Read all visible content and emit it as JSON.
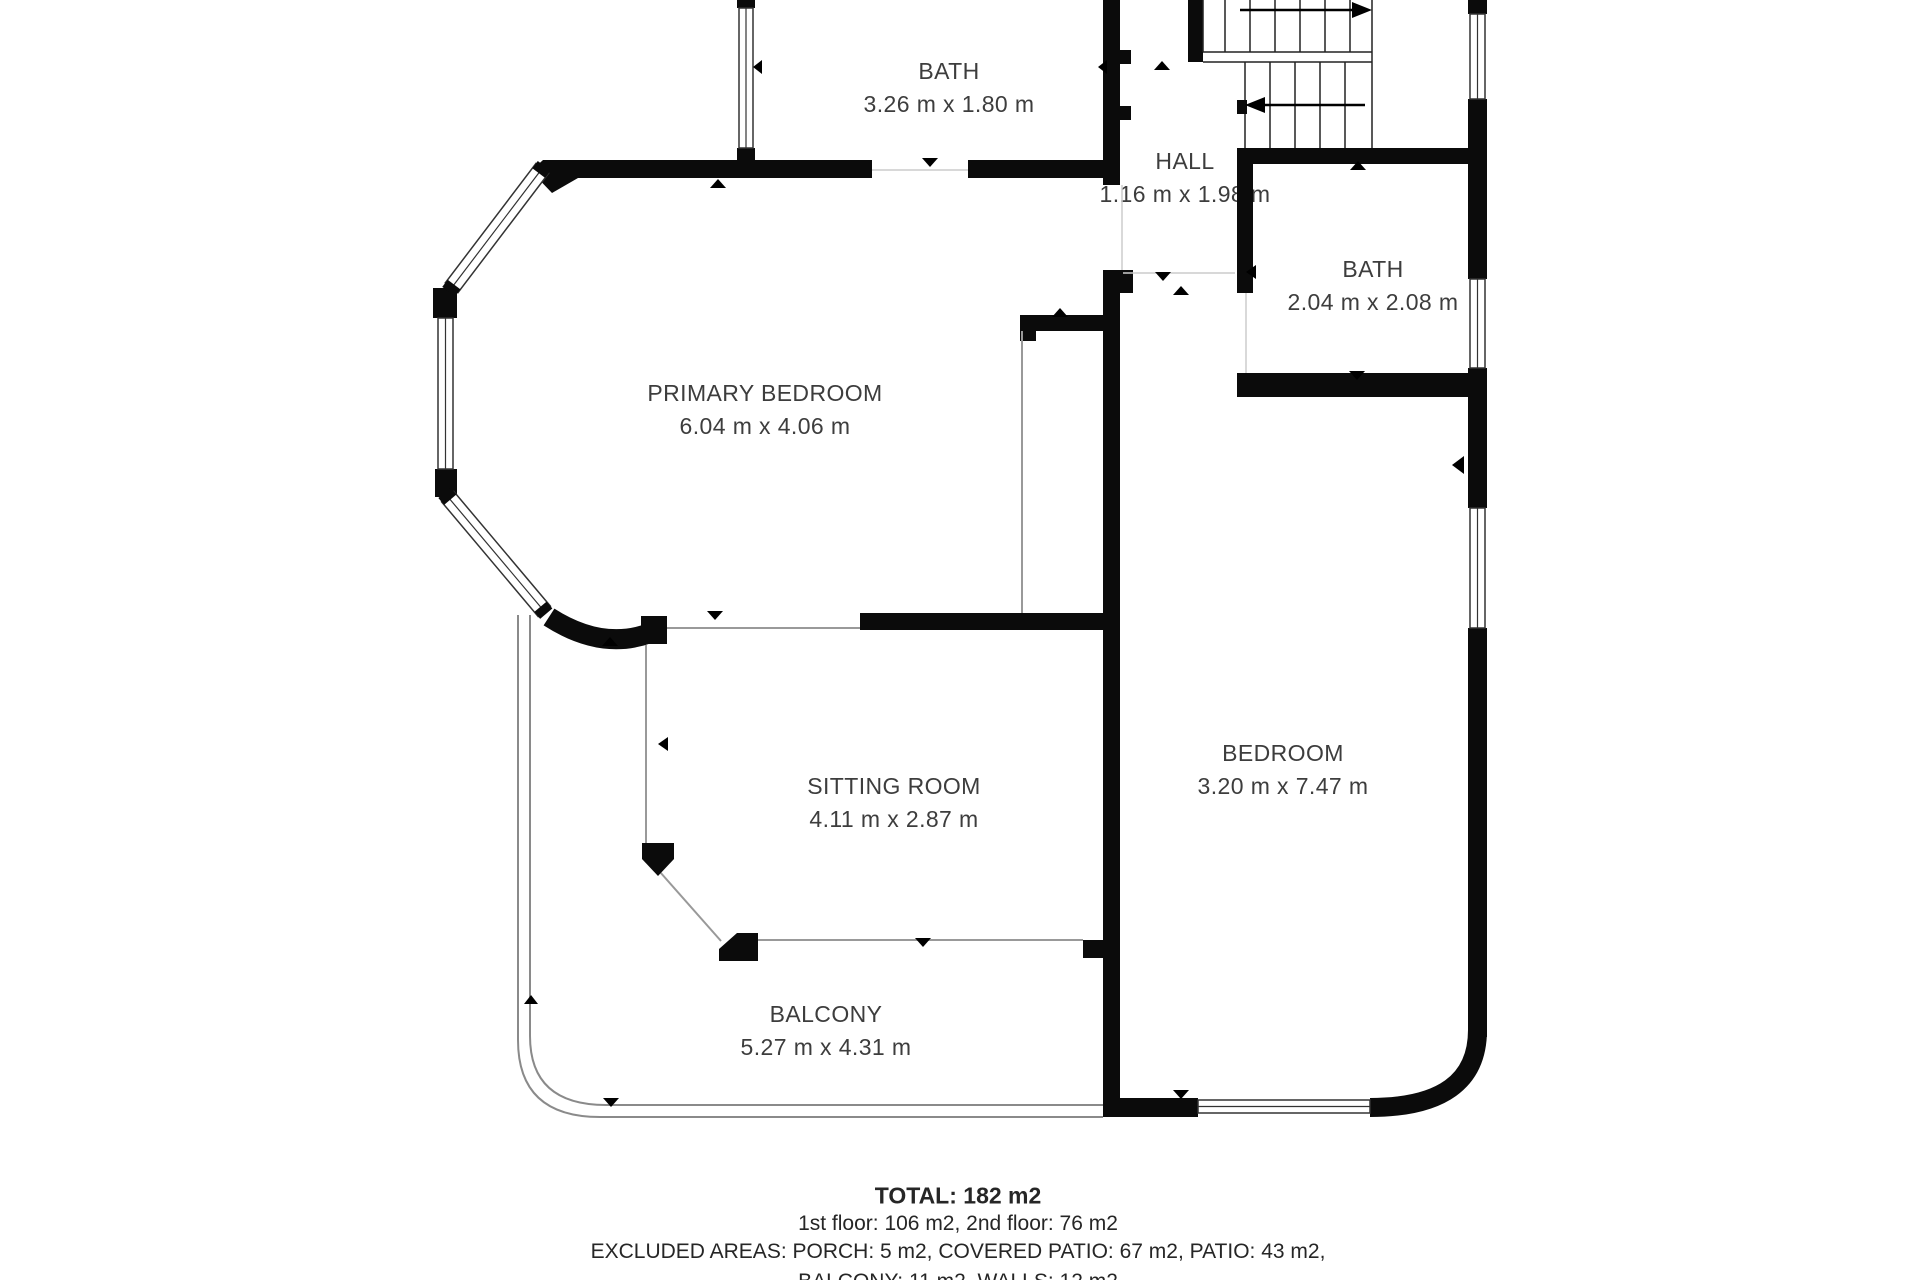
{
  "plan": {
    "title": "second floor plan",
    "rooms": {
      "bath_top": {
        "name": "BATH",
        "dims": "3.26 m x 1.80 m"
      },
      "hall": {
        "name": "HALL",
        "dims": "1.16 m x 1.98 m"
      },
      "bath_right": {
        "name": "BATH",
        "dims": "2.04 m x 2.08 m"
      },
      "primary_bedroom": {
        "name": "PRIMARY BEDROOM",
        "dims": "6.04 m x 4.06 m"
      },
      "sitting_room": {
        "name": "SITTING ROOM",
        "dims": "4.11 m x 2.87 m"
      },
      "bedroom": {
        "name": "BEDROOM",
        "dims": "3.20 m x 7.47 m"
      },
      "balcony": {
        "name": "BALCONY",
        "dims": "5.27 m x 4.31 m"
      }
    },
    "summary": {
      "total": "TOTAL: 182 m2",
      "floors": "1st floor: 106 m2, 2nd floor: 76 m2",
      "excluded1": "EXCLUDED AREAS: PORCH: 5 m2, COVERED PATIO: 67 m2, PATIO: 43 m2,",
      "excluded2": "BALCONY: 11 m2, WALLS: 12 m2"
    },
    "colors": {
      "wall": "#0b0b0b",
      "window_frame": "#333333",
      "open_boundary": "#999999",
      "railing": "#8a8a8a",
      "door_gap": "#cccccc",
      "text": "#3d3d3d"
    }
  }
}
